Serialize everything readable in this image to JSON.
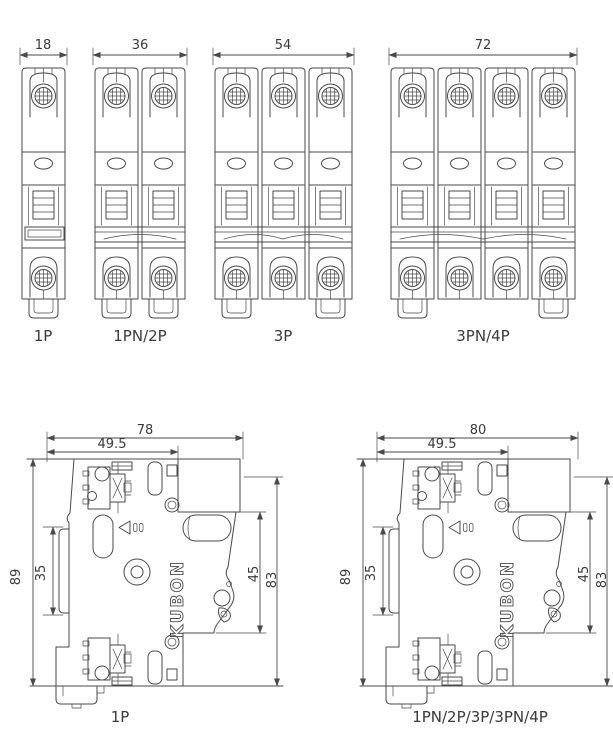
{
  "drawing": {
    "brand_vertical_text": "KUBON",
    "front_views": [
      {
        "label": "1P",
        "poles": 1,
        "width_mm": "18"
      },
      {
        "label": "1PN/2P",
        "poles": 2,
        "width_mm": "36"
      },
      {
        "label": "3P",
        "poles": 3,
        "width_mm": "54"
      },
      {
        "label": "3PN/4P",
        "poles": 4,
        "width_mm": "72"
      }
    ],
    "side_views": [
      {
        "label": "1P",
        "overall_width_mm": "78",
        "front_section_width_mm": "49.5",
        "overall_height_mm": "89",
        "rail_recess_mm": "35",
        "terminal_span_mm": "45",
        "body_height_mm": "83"
      },
      {
        "label": "1PN/2P/3P/3PN/4P",
        "overall_width_mm": "80",
        "front_section_width_mm": "49.5",
        "overall_height_mm": "89",
        "rail_recess_mm": "35",
        "terminal_span_mm": "45",
        "body_height_mm": "83"
      }
    ]
  },
  "colors": {
    "line": "#4a4a4a",
    "text": "#3a3a3a",
    "background": "#ffffff"
  }
}
